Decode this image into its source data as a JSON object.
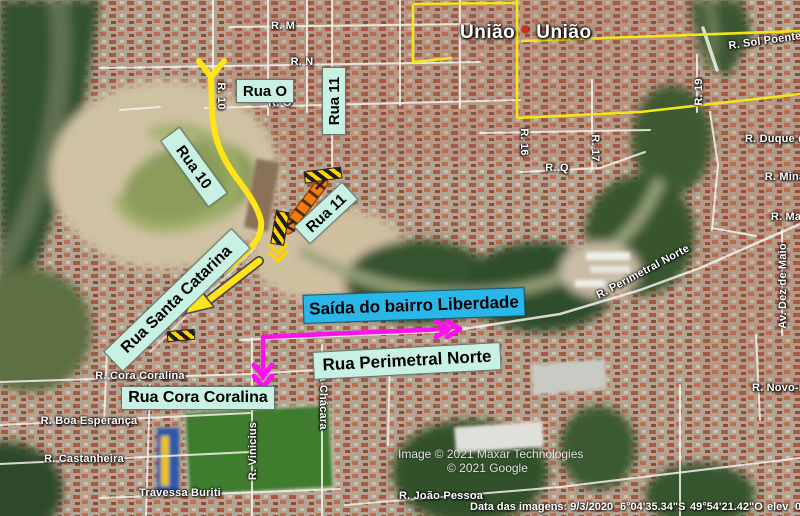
{
  "map": {
    "place_label": {
      "first": "União",
      "second": "União"
    },
    "road_labels": {
      "rm": "R. M",
      "rn": "R. N",
      "ro": "R. O",
      "rq": "R. Q",
      "r10": "R. 10",
      "r16": "R. 16",
      "r17": "R. 17",
      "r19": "R. 19",
      "sol_poente": "R. Sol Poente",
      "duque": "R. Duque d",
      "mina": "R. Mina",
      "ma": "R. Ma",
      "dez_de_maio": "Av. Dez de Maio",
      "perimetral_norte": "R. Perimetral Norte",
      "novo": "R. Novo-I",
      "cora_coralina": "R. Cora Coralina",
      "boa_esperanca": "R. Boa Esperança",
      "castanheira": "R. Castanheira",
      "travessa_buriti": "Travessa Buriti",
      "joao_pessoa": "R. João Pessoa",
      "vinicius": "R. Vinicius",
      "da_chacara": "da Chácara"
    },
    "annotations": {
      "rua_o": "Rua O",
      "rua_11_vertical": "Rua 11",
      "rua_10": "Rua 10",
      "rua_11_diagonal": "Rua 11",
      "rua_santa_catarina": "Rua Santa Catarina",
      "saida_bairro": "Saída do bairro Liberdade",
      "rua_perimetral_norte": "Rua Perimetral Norte",
      "rua_cora_coralina": "Rua Cora Coralina"
    },
    "status": {
      "imagery_credit": "Image © 2021 Maxar Technologies",
      "google_credit": "© 2021 Google",
      "image_date": "Data das imagens: 9/3/2020",
      "latitude": "6°04'35.34\"S",
      "longitude": "49°54'21.42\"O",
      "elev_label": "elev",
      "elev_value": "0"
    },
    "colors": {
      "route_yellow": "#ffe41a",
      "route_magenta": "#ff10ee",
      "construction_orange": "#ef7b12",
      "callout_cyan": "#29b6e8",
      "callout_mint": "#c9f1e3",
      "road_yellow": "#f2e71c"
    }
  }
}
